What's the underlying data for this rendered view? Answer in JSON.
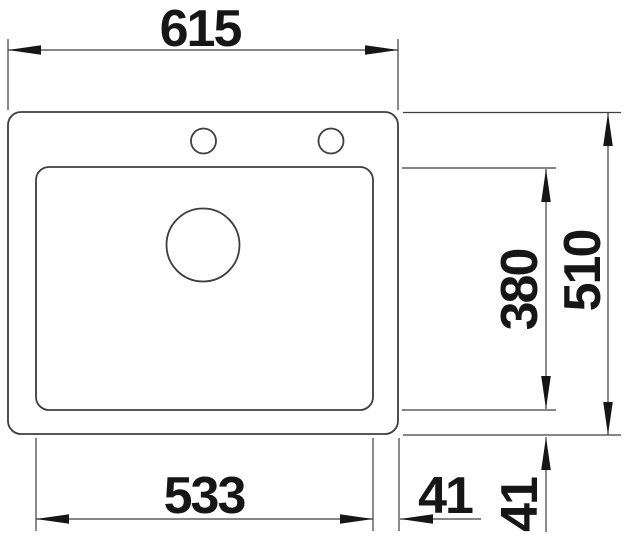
{
  "diagram": {
    "type": "technical-dimension-drawing",
    "subject": "sink top view with faucet holes, basin and drain",
    "units": "mm",
    "colors": {
      "background": "#ffffff",
      "line": "#3e3e3e",
      "text": "#161616"
    },
    "dimensions": {
      "overall_width": "615",
      "overall_depth": "510",
      "basin_width": "533",
      "basin_depth": "380",
      "basin_to_right_edge": "41",
      "basin_to_bottom_edge": "41"
    }
  }
}
